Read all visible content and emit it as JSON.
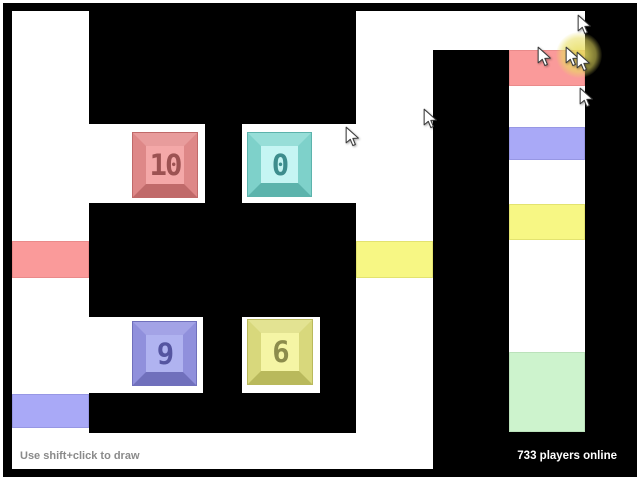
{
  "hud": {
    "hint": "Use shift+click to draw",
    "players_online": "733 players online"
  },
  "colors": {
    "wall": "#000000",
    "floor": "#ffffff",
    "door_red": "#fa9a9a",
    "door_red_border": "#ea8a8a",
    "door_blue": "#a9a9f7",
    "door_blue_border": "#9797e4",
    "door_yellow": "#f7f784",
    "door_yellow_border": "#e3e370",
    "door_green": "#cdf3cd",
    "door_green_border": "#bbe2bb",
    "click_glow": "#e8de5f"
  },
  "maze": {
    "floors": [
      {
        "name": "corridor-left",
        "x": 12,
        "y": 11,
        "w": 77,
        "h": 458
      },
      {
        "name": "room-top-left",
        "x": 89,
        "y": 124,
        "w": 116,
        "h": 79
      },
      {
        "name": "room-top-right",
        "x": 242,
        "y": 124,
        "w": 191,
        "h": 79
      },
      {
        "name": "room-bottom-left",
        "x": 89,
        "y": 317,
        "w": 114,
        "h": 76
      },
      {
        "name": "room-bottom-right",
        "x": 242,
        "y": 317,
        "w": 78,
        "h": 76
      },
      {
        "name": "top-area",
        "x": 356,
        "y": 11,
        "w": 229,
        "h": 39
      },
      {
        "name": "corridor-middle",
        "x": 356,
        "y": 50,
        "w": 77,
        "h": 419
      },
      {
        "name": "bottom-strip",
        "x": 12,
        "y": 433,
        "w": 421,
        "h": 36
      },
      {
        "name": "column-right",
        "x": 509,
        "y": 50,
        "w": 76,
        "h": 382
      }
    ],
    "doors": [
      {
        "name": "door-red-left",
        "color": "door_red",
        "border": "door_red_border",
        "x": 12,
        "y": 241,
        "w": 77,
        "h": 37
      },
      {
        "name": "door-blue-left",
        "color": "door_blue",
        "border": "door_blue_border",
        "x": 12,
        "y": 394,
        "w": 77,
        "h": 34
      },
      {
        "name": "door-yellow-mid",
        "color": "door_yellow",
        "border": "door_yellow_border",
        "x": 356,
        "y": 241,
        "w": 77,
        "h": 37
      },
      {
        "name": "door-red-right",
        "color": "door_red",
        "border": "door_red_border",
        "x": 509,
        "y": 50,
        "w": 76,
        "h": 36
      },
      {
        "name": "door-blue-right",
        "color": "door_blue",
        "border": "door_blue_border",
        "x": 509,
        "y": 127,
        "w": 76,
        "h": 33
      },
      {
        "name": "door-yellow-right",
        "color": "door_yellow",
        "border": "door_yellow_border",
        "x": 509,
        "y": 204,
        "w": 76,
        "h": 36
      },
      {
        "name": "door-green-right",
        "color": "door_green",
        "border": "door_green_border",
        "x": 509,
        "y": 352,
        "w": 76,
        "h": 80
      }
    ]
  },
  "buttons": [
    {
      "label": "10",
      "scheme": "red",
      "x": 133,
      "y": 133,
      "size": 64
    },
    {
      "label": "0",
      "scheme": "cyan",
      "x": 248,
      "y": 133,
      "size": 63
    },
    {
      "label": "9",
      "scheme": "blue",
      "x": 133,
      "y": 322,
      "size": 63
    },
    {
      "label": "6",
      "scheme": "yellow",
      "x": 248,
      "y": 320,
      "size": 64
    }
  ],
  "button_schemes": {
    "red": {
      "frame": "#de8888",
      "light": "#e89c9c",
      "dark": "#c06a6a",
      "inner": "#f4a8a8",
      "text": "#9c5252"
    },
    "cyan": {
      "frame": "#7ed1ca",
      "light": "#97ded8",
      "dark": "#5cb3ac",
      "inner": "#c5f5f3",
      "text": "#3d8d8d"
    },
    "blue": {
      "frame": "#9090dc",
      "light": "#a3a3e6",
      "dark": "#7070bc",
      "inner": "#b0b3f0",
      "text": "#5555a0"
    },
    "yellow": {
      "frame": "#d8d87c",
      "light": "#e3e392",
      "dark": "#b9b95c",
      "inner": "#f5f5a5",
      "text": "#8c8c4c"
    }
  },
  "cursors": [
    {
      "x": 578,
      "y": 15
    },
    {
      "x": 538,
      "y": 47
    },
    {
      "x": 566,
      "y": 47
    },
    {
      "x": 577,
      "y": 52
    },
    {
      "x": 580,
      "y": 88
    },
    {
      "x": 424,
      "y": 109
    },
    {
      "x": 346,
      "y": 127
    }
  ],
  "click_effect": {
    "x": 579,
    "y": 55
  }
}
